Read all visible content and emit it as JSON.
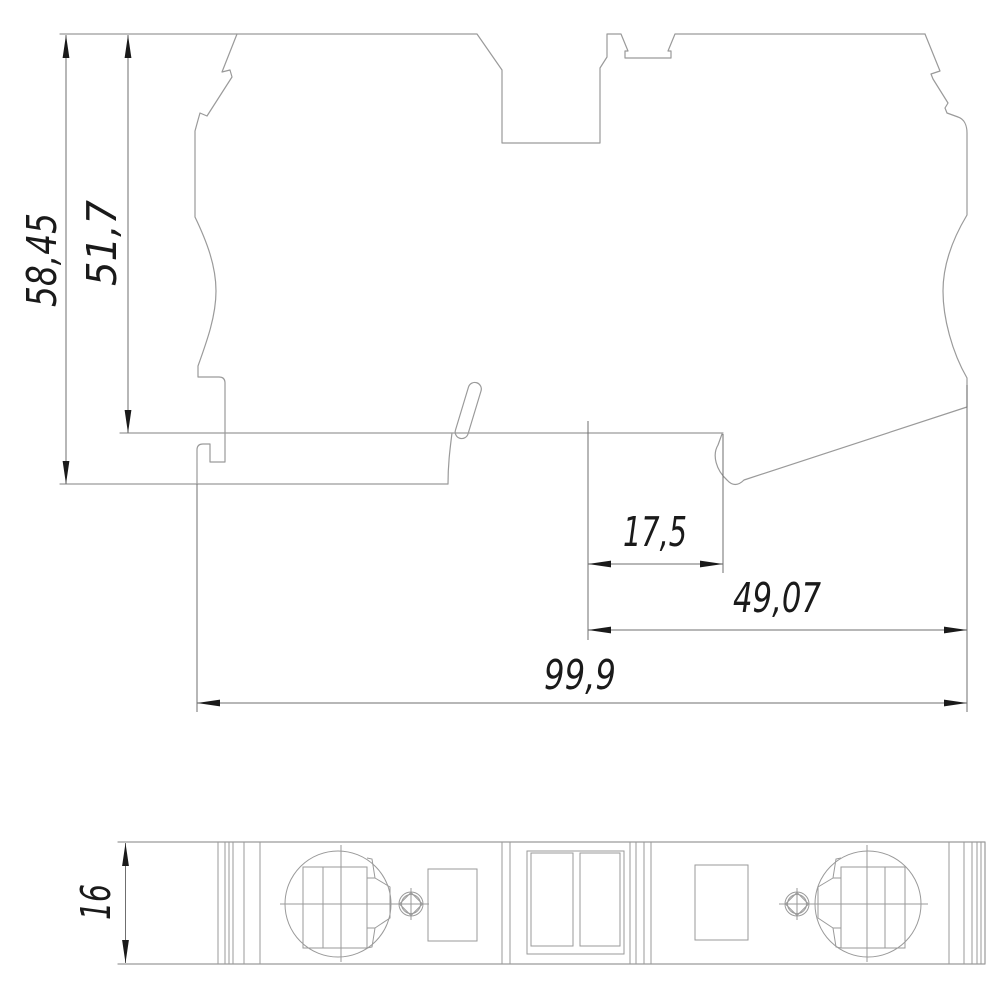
{
  "page": {
    "background": "#ffffff"
  },
  "palette": {
    "background": "#ffffff",
    "outline": "#9a9a9a",
    "dimension_lines": "#6f6f6f",
    "ink": "#1a1a1a"
  },
  "views": {
    "side_view": {
      "id": "side-view"
    },
    "bottom_view": {
      "id": "bottom-view"
    }
  },
  "dimensions": {
    "total_height": {
      "label": "58,45"
    },
    "upper_height": {
      "label": "51,7"
    },
    "rail_center_offset": {
      "label": "17,5"
    },
    "right_span": {
      "label": "49,07"
    },
    "total_length": {
      "label": "99,9"
    },
    "depth": {
      "label": "16"
    }
  }
}
